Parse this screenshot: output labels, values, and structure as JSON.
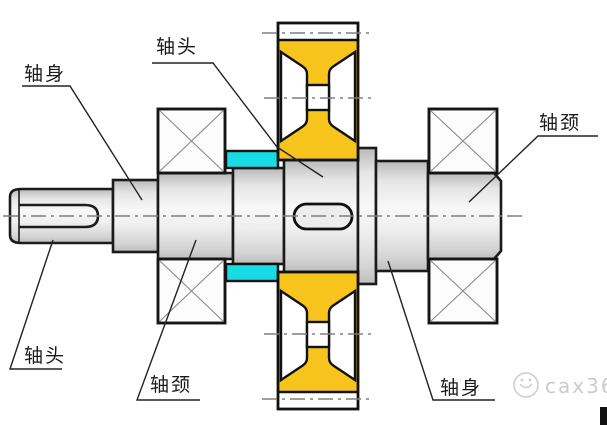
{
  "diagram": {
    "type": "shaft-structure-section-drawing",
    "labels": {
      "top_left": "轴身",
      "top_center": "轴头",
      "top_right": "轴颈",
      "bottom_left": "轴头",
      "bottom_center": "轴颈",
      "bottom_right": "轴身"
    },
    "parts": {
      "gear": "gear-with-web",
      "bearings": "rolling-bearing-x-symbol",
      "spacers": "cyan-spacer-rings",
      "keyways": "keyway-slots"
    },
    "colors": {
      "gear_fill": "#f6c41c",
      "spacer_fill": "#18dce4",
      "outline": "#1b1b1b",
      "centerline": "#7f7f7f",
      "shaft_light": "#f7f7f7",
      "shaft_dark": "#bdbdbd",
      "watermark": "#cbcbcb"
    }
  },
  "watermark": {
    "text": "cax360",
    "logo": "smiley-circle-icon"
  }
}
